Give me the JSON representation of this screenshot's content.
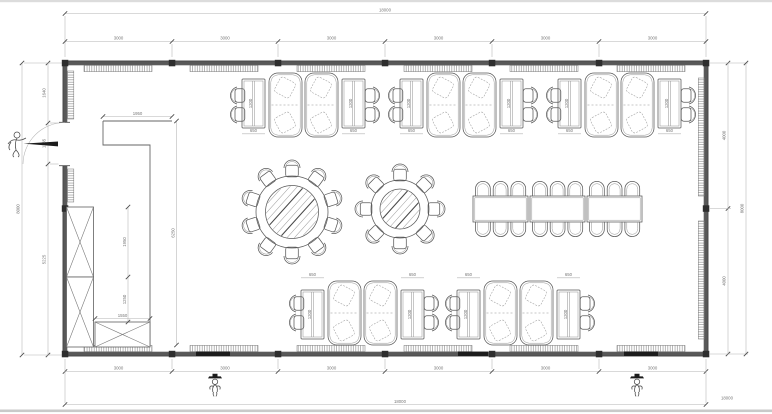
{
  "dims": {
    "top_overall": "18000",
    "top_segments": [
      "3000",
      "3000",
      "3000",
      "3000",
      "3000",
      "3000"
    ],
    "bottom_overall": "18000",
    "bottom_segments": [
      "3000",
      "3000",
      "3000",
      "3000",
      "3000",
      "3000"
    ],
    "left_overall": "8000",
    "left_segments": [
      "1640",
      "1135",
      "5225"
    ],
    "right_overall": "8000",
    "right_segments": [
      "4000",
      "4000"
    ]
  },
  "interior": {
    "counter_length": "1950",
    "counter_run": "6250",
    "cabinet_upper": "1950",
    "cabinet_lower": "1250",
    "cabinet_width": "1550",
    "booth_table_width": "650",
    "booth_table_depth": "1200"
  },
  "colors": {
    "wall": "#585858",
    "furniture_line": "#5a5a5a",
    "dimension_line": "#b3b3b3",
    "dimension_text": "#787878"
  }
}
